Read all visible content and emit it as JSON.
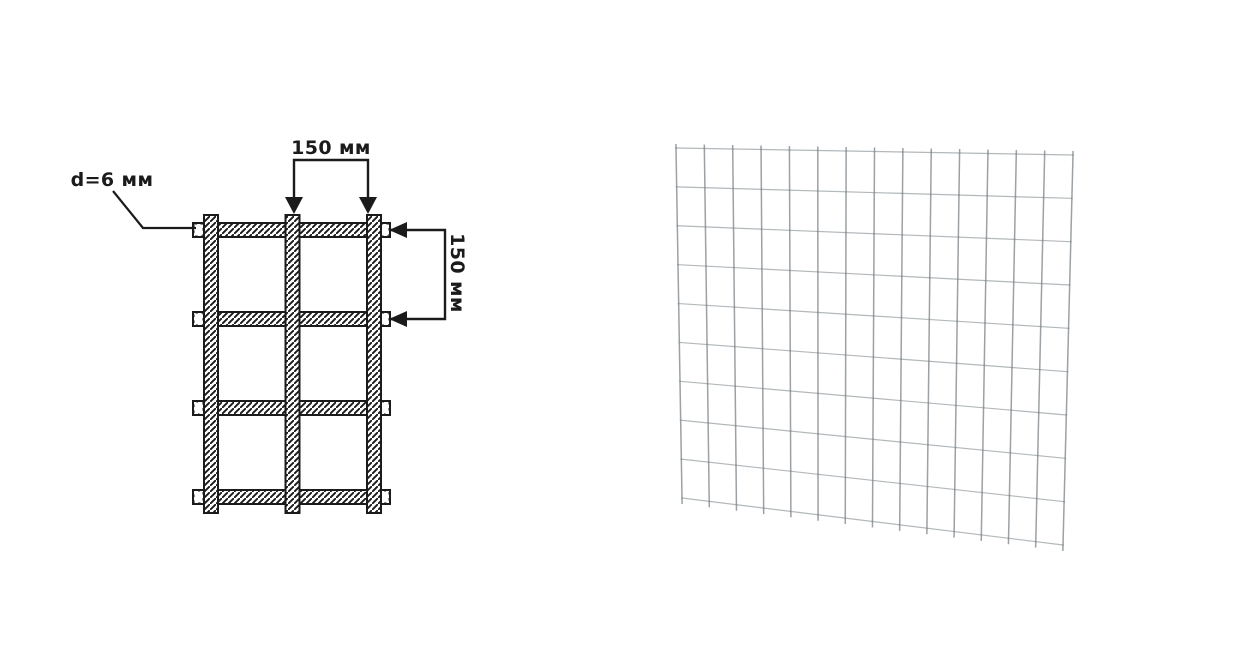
{
  "page": {
    "background": "#ffffff",
    "ink_color": "#1b1b1b"
  },
  "schematic": {
    "labels": {
      "wire_diameter": "d=6 мм",
      "horizontal_spacing": "150 мм",
      "vertical_spacing": "150 мм"
    },
    "vertical_bars": 3,
    "horizontal_bars": 4
  },
  "mesh_render": {
    "vertical_wires": 15,
    "horizontal_wires": 10,
    "wire_color_vertical": "#9ba1a5",
    "wire_color_horizontal": "#b3b8bb",
    "joint_color": "#868c90"
  }
}
